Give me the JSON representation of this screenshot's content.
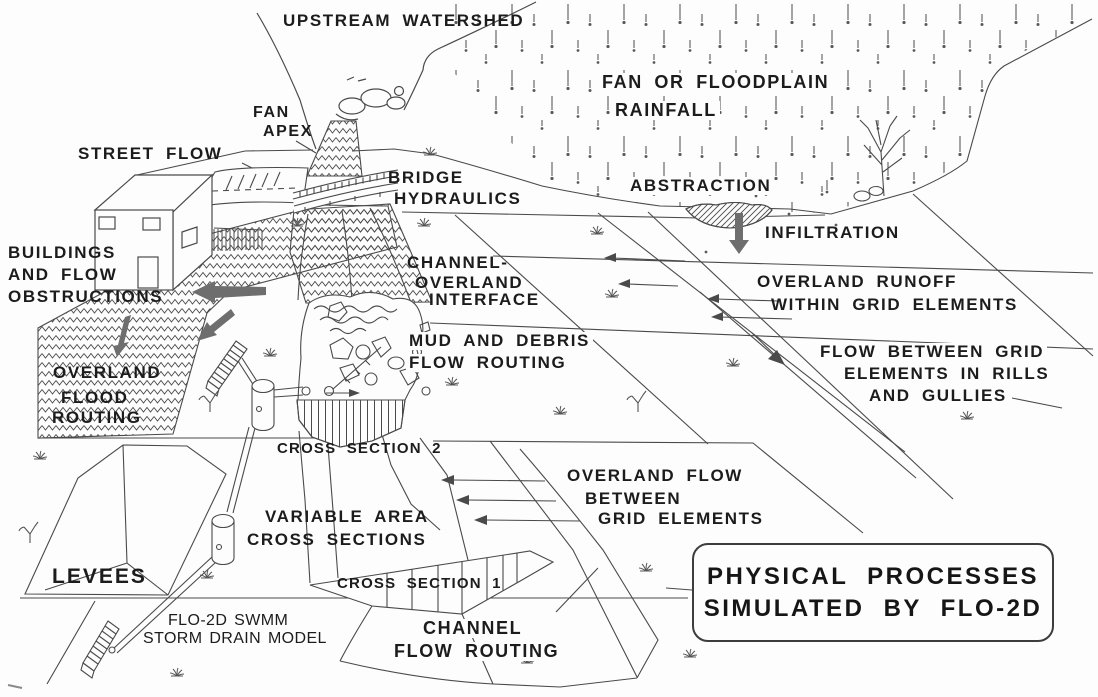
{
  "diagram": {
    "title": {
      "line1": "PHYSICAL PROCESSES",
      "line2": "SIMULATED BY FLO-2D"
    },
    "labels": {
      "upstream_watershed": "UPSTREAM WATERSHED",
      "rainfall_line1": "FAN OR FLOODPLAIN",
      "rainfall_line2": "RAINFALL",
      "fan_apex_line1": "FAN",
      "fan_apex_line2": "APEX",
      "street_flow": "STREET FLOW",
      "bridge_line1": "BRIDGE",
      "bridge_line2": "HYDRAULICS",
      "abstraction": "ABSTRACTION",
      "infiltration": "INFILTRATION",
      "buildings_line1": "BUILDINGS",
      "buildings_line2": "AND FLOW",
      "buildings_line3": "OBSTRUCTIONS",
      "interface_line1": "CHANNEL-",
      "interface_line2": "OVERLAND",
      "interface_line3": "INTERFACE",
      "runoff_line1": "OVERLAND RUNOFF",
      "runoff_line2": "WITHIN GRID ELEMENTS",
      "mud_line1": "MUD AND DEBRIS",
      "mud_line2": "FLOW ROUTING",
      "rills_line1": "FLOW BETWEEN GRID",
      "rills_line2": "ELEMENTS IN RILLS",
      "rills_line3": "AND GULLIES",
      "overland_flood_line1": "OVERLAND",
      "overland_flood_line2": "FLOOD",
      "overland_flood_line3": "ROUTING",
      "cross_section_2": "CROSS SECTION 2",
      "overland_between_line1": "OVERLAND FLOW",
      "overland_between_line2": "BETWEEN",
      "overland_between_line3": "GRID ELEMENTS",
      "variable_line1": "VARIABLE AREA",
      "variable_line2": "CROSS SECTIONS",
      "levees": "LEVEES",
      "cross_section_1": "CROSS SECTION 1",
      "swmm_line1": "FLO-2D SWMM",
      "swmm_line2": "STORM DRAIN MODEL",
      "channel_routing_line1": "CHANNEL",
      "channel_routing_line2": "FLOW ROUTING"
    },
    "colors": {
      "ink": "#4a4a4a",
      "text": "#1c1c1c",
      "arrow_gray": "#6e6e6e",
      "background": "#fdfdfd"
    }
  }
}
